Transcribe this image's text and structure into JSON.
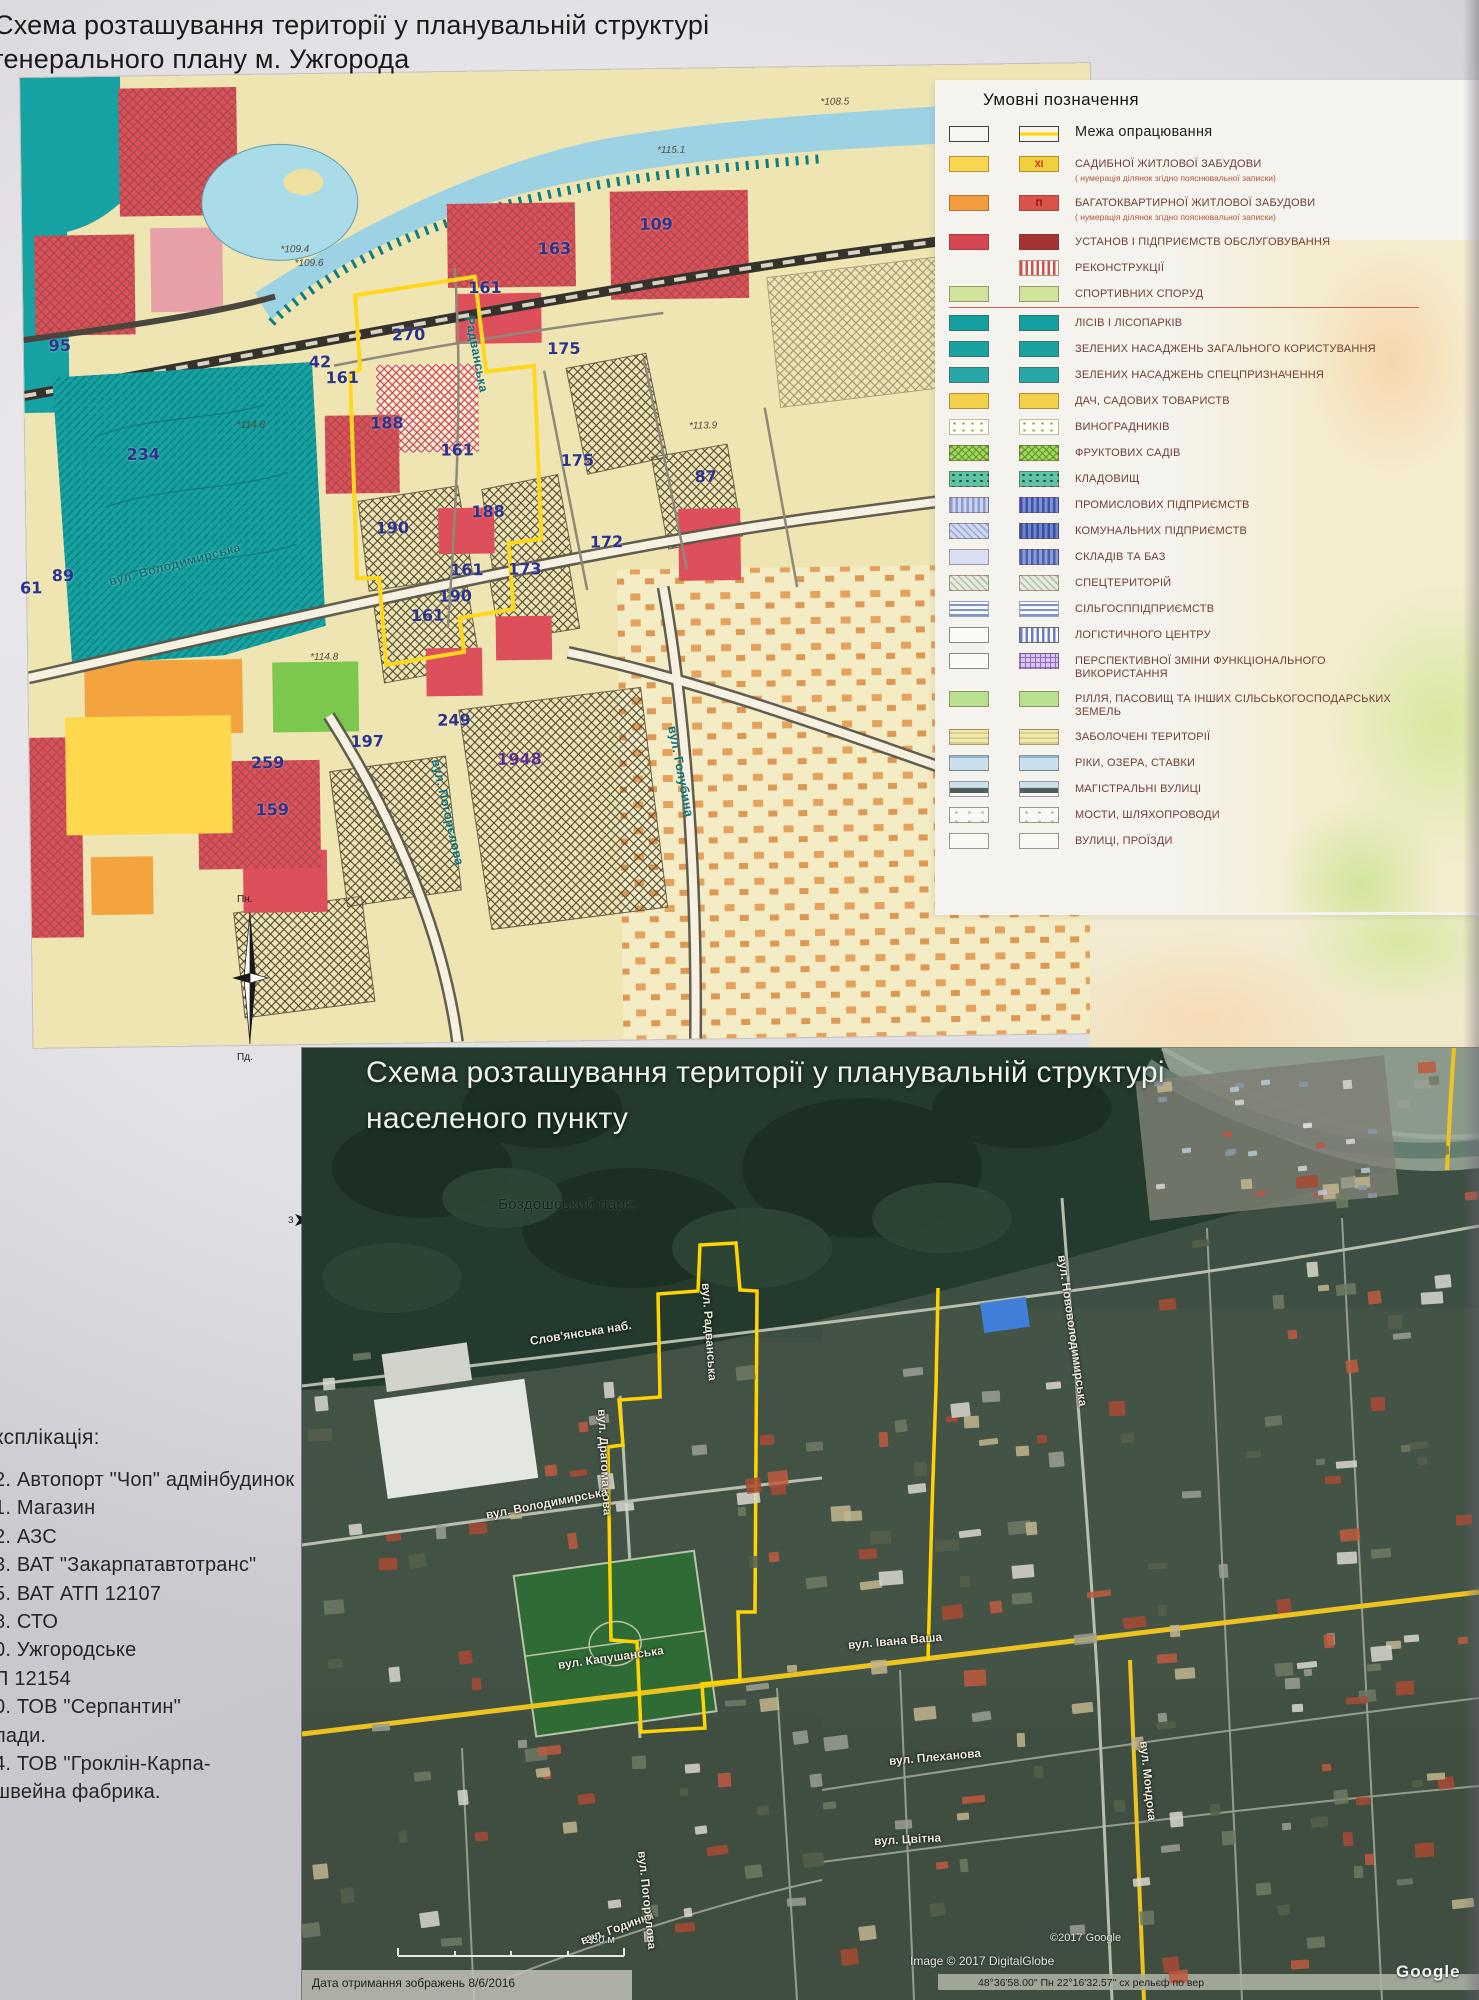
{
  "page": {
    "title_line1": "Схема розташування території у планувальній структурі",
    "title_line2": "генерального плану м. Ужгорода"
  },
  "colors": {
    "boundary_yellow": "#ffd400",
    "legend_text": "#6e4034",
    "map_number_navy": "#2d3488",
    "road_yellow": "#edc41f"
  },
  "legend": {
    "title": "Умовні позначення",
    "items": [
      {
        "label": "Межа опрацювання",
        "big": true,
        "sw1": {
          "bg": "#f7f5f0",
          "bd": "#444"
        },
        "sw2": {
          "bg": "#f7f5f0",
          "bd": "#444",
          "pat": "band",
          "pc": "#ffd400"
        }
      },
      {
        "label": "САДИБНОЇ ЖИТЛОВОЇ ЗАБУДОВИ",
        "sub": "( нумерація ділянок згідно пояснювальної записки)",
        "sw1": {
          "bg": "#f7d74f"
        },
        "sw2": {
          "bg": "#f2cf3d",
          "badge": "XI",
          "bc": "#cc2222"
        }
      },
      {
        "label": "БАГАТОКВАРТИРНОЇ ЖИТЛОВОЇ ЗАБУДОВИ",
        "sub": "( нумерація ділянок згідно пояснювальної записки)",
        "sw1": {
          "bg": "#f29b3f"
        },
        "sw2": {
          "bg": "#d9534a",
          "badge": "П",
          "bc": "#7d150e"
        }
      },
      {
        "label": "УСТАНОВ І ПІДПРИЄМСТВ ОБСЛУГОВУВАННЯ",
        "sw1": {
          "bg": "#d64552"
        },
        "sw2": {
          "bg": "#a33431"
        }
      },
      {
        "label": "РЕКОНСТРУКЦІЇ",
        "sw1": {
          "bg": "transparent",
          "bd": "transparent"
        },
        "sw2": {
          "bg": "#fdfbf7",
          "pat": "sv",
          "pc": "#d05050",
          "bd": "#c08878"
        }
      },
      {
        "label": "СПОРТИВНИХ СПОРУД",
        "divider": true,
        "sw1": {
          "bg": "#cfe49a"
        },
        "sw2": {
          "bg": "#cfe49a"
        }
      },
      {
        "label": "ЛІСІВ І ЛІСОПАРКІВ",
        "sw1": {
          "bg": "#14a0a0"
        },
        "sw2": {
          "bg": "#14a0a0"
        }
      },
      {
        "label": "ЗЕЛЕНИХ НАСАДЖЕНЬ ЗАГАЛЬНОГО КОРИСТУВАННЯ",
        "sw1": {
          "bg": "#1aa2a2"
        },
        "sw2": {
          "bg": "#1aa2a2"
        }
      },
      {
        "label": "ЗЕЛЕНИХ НАСАДЖЕНЬ СПЕЦПРИЗНАЧЕННЯ",
        "sw1": {
          "bg": "#27a6a6"
        },
        "sw2": {
          "bg": "#27a6a6"
        }
      },
      {
        "label": "ДАЧ, САДОВИХ ТОВАРИСТВ",
        "sw1": {
          "bg": "#f2d24b"
        },
        "sw2": {
          "bg": "#f2d24b"
        }
      },
      {
        "label": "ВИНОГРАДНИКІВ",
        "sw1": {
          "bg": "#fdfdf6",
          "pat": "vine",
          "pc": "#79b43e",
          "bd": "#c8b8a8"
        },
        "sw2": {
          "bg": "#fdfdf6",
          "pat": "vine",
          "pc": "#79b43e",
          "bd": "#c8b8a8"
        }
      },
      {
        "label": "ФРУКТОВИХ САДІВ",
        "sw1": {
          "bg": "#a6d45e",
          "pat": "cross",
          "pc": "#5d9c2c"
        },
        "sw2": {
          "bg": "#a6d45e",
          "pat": "cross",
          "pc": "#5d9c2c"
        }
      },
      {
        "label": "КЛАДОВИЩ",
        "sw1": {
          "bg": "#5fc3a4",
          "pat": "dots",
          "pc": "#14534a"
        },
        "sw2": {
          "bg": "#5fc3a4",
          "pat": "dots",
          "pc": "#14534a"
        }
      },
      {
        "label": "ПРОМИСЛОВИХ ПІДПРИЄМСТВ",
        "sw1": {
          "bg": "#c9d3ec",
          "pat": "sv",
          "pc": "#8a9cd4"
        },
        "sw2": {
          "bg": "#7b8fd2",
          "pat": "sv",
          "pc": "#3d52a8"
        }
      },
      {
        "label": "КОМУНАЛЬНИХ ПІДПРИЄМСТВ",
        "sw1": {
          "bg": "#cfd8ee",
          "pat": "hx",
          "pc": "#97a8da"
        },
        "sw2": {
          "bg": "#6e84cc",
          "pat": "sv",
          "pc": "#3a4e9e"
        }
      },
      {
        "label": "СКЛАДІВ ТА БАЗ",
        "sw1": {
          "bg": "#d8dff2"
        },
        "sw2": {
          "bg": "#8a9dda",
          "pat": "sv",
          "pc": "#4a5fae"
        }
      },
      {
        "label": "СПЕЦТЕРИТОРІЙ",
        "sw1": {
          "bg": "#e6eadd",
          "pat": "hx",
          "pc": "#adbfad"
        },
        "sw2": {
          "bg": "#e6eadd",
          "pat": "hx",
          "pc": "#adbfad"
        }
      },
      {
        "label": "СІЛЬГОСППІДПРИЄМСТВ",
        "sw1": {
          "bg": "#f6f8fc",
          "pat": "sh",
          "pc": "#7d94c6",
          "bd": "#9aa2b8"
        },
        "sw2": {
          "bg": "#f6f8fc",
          "pat": "sh",
          "pc": "#7d94c6",
          "bd": "#9aa2b8"
        }
      },
      {
        "label": "ЛОГІСТИЧНОГО ЦЕНТРУ",
        "sw1": {
          "bg": "#fbfaf7",
          "bd": "#888"
        },
        "sw2": {
          "bg": "#fbfaf7",
          "pat": "sv",
          "pc": "#6b7fc4",
          "bd": "#667"
        }
      },
      {
        "label": "ПЕРСПЕКТИВНОЇ ЗМІНИ ФУНКЦІОНАЛЬНОГО ВИКОРИСТАННЯ",
        "sw1": {
          "bg": "#fbfaf7",
          "bd": "#888"
        },
        "sw2": {
          "bg": "#d9c8ee",
          "pat": "grid",
          "pc": "#8f68c8"
        }
      },
      {
        "label": "РІЛЛЯ, ПАСОВИЩ ТА ІНШИХ СІЛЬСЬКОГОСПОДАРСЬКИХ ЗЕМЕЛЬ",
        "sw1": {
          "bg": "#b8e08e"
        },
        "sw2": {
          "bg": "#b8e08e"
        }
      },
      {
        "label": "ЗАБОЛОЧЕНІ ТЕРИТОРІЇ",
        "sw1": {
          "bg": "#efe9ae",
          "pat": "sh",
          "pc": "#d8cf8a"
        },
        "sw2": {
          "bg": "#efe9ae",
          "pat": "sh",
          "pc": "#d8cf8a"
        }
      },
      {
        "label": "РІКИ, ОЗЕРА, СТАВКИ",
        "sw1": {
          "bg": "#cadfed",
          "pat": "riv",
          "pc": "#8fb8d0"
        },
        "sw2": {
          "bg": "#cadfed",
          "pat": "riv",
          "pc": "#8fb8d0"
        }
      },
      {
        "label": "МАГІСТРАЛЬНІ ВУЛИЦІ",
        "sw1": {
          "bg": "#fbfaf7",
          "pat": "mag",
          "pc": "#4e5f58",
          "bd": "#99a"
        },
        "sw2": {
          "bg": "#fbfaf7",
          "pat": "mag",
          "pc": "#4e5f58",
          "bd": "#99a"
        }
      },
      {
        "label": "МОСТИ, ШЛЯХОПРОВОДИ",
        "sw1": {
          "bg": "#f8f7f3",
          "pat": "dots",
          "pc": "#a3bd95",
          "bd": "#998",
          "ps": "13px 9px"
        },
        "sw2": {
          "bg": "#f8f7f3",
          "pat": "dots",
          "pc": "#a3bd95",
          "bd": "#998",
          "ps": "13px 9px"
        }
      },
      {
        "label": "ВУЛИЦІ, ПРОЇЗДИ",
        "sw1": {
          "bg": "#f8f7f3",
          "bd": "#998"
        },
        "sw2": {
          "bg": "#f8f7f3",
          "bd": "#998"
        }
      }
    ]
  },
  "zoning_map": {
    "numbers": [
      {
        "t": "95",
        "x": 36,
        "y": 268
      },
      {
        "t": "234",
        "x": 118,
        "y": 378
      },
      {
        "t": "89",
        "x": 36,
        "y": 498
      },
      {
        "t": "61",
        "x": 4,
        "y": 510
      },
      {
        "t": "42",
        "x": 296,
        "y": 288
      },
      {
        "t": "161",
        "x": 318,
        "y": 304
      },
      {
        "t": "270",
        "x": 385,
        "y": 262
      },
      {
        "t": "188",
        "x": 362,
        "y": 350
      },
      {
        "t": "161",
        "x": 432,
        "y": 378
      },
      {
        "t": "163",
        "x": 532,
        "y": 178
      },
      {
        "t": "109",
        "x": 634,
        "y": 155
      },
      {
        "t": "161",
        "x": 462,
        "y": 216
      },
      {
        "t": "175",
        "x": 540,
        "y": 278
      },
      {
        "t": "175",
        "x": 552,
        "y": 390
      },
      {
        "t": "87",
        "x": 680,
        "y": 408
      },
      {
        "t": "188",
        "x": 462,
        "y": 440
      },
      {
        "t": "190",
        "x": 366,
        "y": 455
      },
      {
        "t": "172",
        "x": 580,
        "y": 472
      },
      {
        "t": "173",
        "x": 498,
        "y": 498
      },
      {
        "t": "161",
        "x": 440,
        "y": 498
      },
      {
        "t": "190",
        "x": 428,
        "y": 524
      },
      {
        "t": "161",
        "x": 400,
        "y": 543
      },
      {
        "t": "249",
        "x": 425,
        "y": 648
      },
      {
        "t": "197",
        "x": 338,
        "y": 668
      },
      {
        "t": "1948",
        "x": 490,
        "y": 688,
        "purple": true
      },
      {
        "t": "259",
        "x": 238,
        "y": 688
      },
      {
        "t": "159",
        "x": 242,
        "y": 735
      }
    ],
    "elevations": [
      {
        "t": "*114.8",
        "x": 212,
        "y": 345
      },
      {
        "t": "*109.4",
        "x": 258,
        "y": 170
      },
      {
        "t": "*109.6",
        "x": 272,
        "y": 184
      },
      {
        "t": "*115.1",
        "x": 636,
        "y": 76
      },
      {
        "t": "*113.9",
        "x": 664,
        "y": 352
      },
      {
        "t": "*114.8",
        "x": 282,
        "y": 578
      },
      {
        "t": "*108.5",
        "x": 800,
        "y": 30
      }
    ],
    "streets": [
      {
        "t": "вул. Володимирська",
        "x": 82,
        "y": 498,
        "r": -14
      },
      {
        "t": "Радванська",
        "x": 446,
        "y": 238,
        "r": 80
      },
      {
        "t": "вул. Голубина",
        "x": 643,
        "y": 650,
        "r": 80
      },
      {
        "t": "вул. Погорєлова",
        "x": 406,
        "y": 680,
        "r": 78
      }
    ]
  },
  "compass": {
    "north": "Пн.",
    "south": "Пд.",
    "side_letter": "З"
  },
  "explication": {
    "heading": "ксплікація:",
    "items": [
      "2. Автопорт \"Чоп\" адмінбудинок",
      "1. Магазин",
      "2. АЗС",
      "3. ВАТ \"Закарпатавтотранс\"",
      "5. ВАТ АТП 12107",
      "8. СТО",
      "0. Ужгородське",
      "П 12154",
      "0. ТОВ \"Серпантин\"",
      "лади.",
      "4. ТОВ \"Гроклін-Карпа-",
      "швейна фабрика."
    ]
  },
  "satellite": {
    "title_line1": "Схема розташування території у планувальній структурі",
    "title_line2": "населеного пункту",
    "park_label": "Боздошський парк.",
    "streets": [
      {
        "t": "Слов'янська наб.",
        "x": 228,
        "y": 286,
        "r": -9
      },
      {
        "t": "вул. Радванська",
        "x": 404,
        "y": 228,
        "r": 86
      },
      {
        "t": "вул. Драгоманова",
        "x": 300,
        "y": 354,
        "r": 87
      },
      {
        "t": "вул. Володимирська",
        "x": 184,
        "y": 460,
        "r": -11
      },
      {
        "t": "вул. Капушанська",
        "x": 256,
        "y": 610,
        "r": -8
      },
      {
        "t": "вул. Івана Ваша",
        "x": 546,
        "y": 590,
        "r": -5
      },
      {
        "t": "вул. Плеханова",
        "x": 587,
        "y": 706,
        "r": -5
      },
      {
        "t": "вул. Цвітна",
        "x": 572,
        "y": 786,
        "r": -3
      },
      {
        "t": "вул. Годинки",
        "x": 279,
        "y": 886,
        "r": -20
      },
      {
        "t": "вул. Нововолодимирська",
        "x": 760,
        "y": 200,
        "r": 82
      },
      {
        "t": "вул. Мондока",
        "x": 842,
        "y": 686,
        "r": 84
      },
      {
        "t": "вул. Погорєлова",
        "x": 340,
        "y": 796,
        "r": 84
      }
    ],
    "scale_label": "250 м",
    "credit_google": "©2017 Google",
    "credit_digitalglobe": "Image © 2017 DigitalGlobe",
    "capture_date": "Дата отримання зображень 8/6/2016",
    "coords_line": "48°36'58.00\" Пн   22°16'32.57\" сх    рельєф по вер",
    "google_logo": "Google"
  }
}
